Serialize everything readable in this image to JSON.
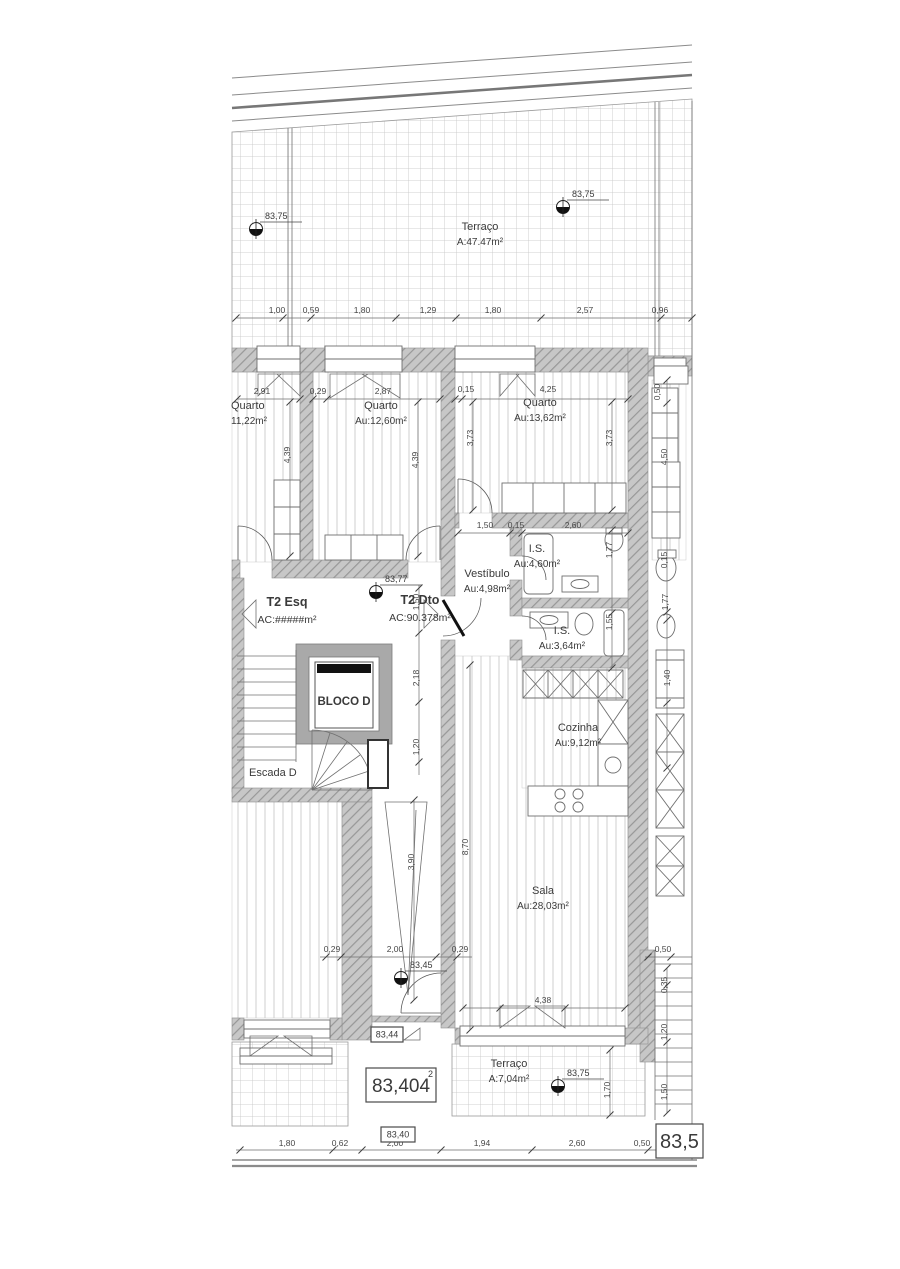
{
  "document_type": "architectural-floor-plan",
  "colors": {
    "wall_fill": "#c7c7c7",
    "wall_hatch": "#979797",
    "line": "#707070",
    "text": "#3a3a3a",
    "background": "#ffffff"
  },
  "plan": {
    "rooms": [
      {
        "name": "Terraço",
        "area": "A:47.47m²",
        "x": 480,
        "y": 230
      },
      {
        "name": "Quarto",
        "area": "11,22m²",
        "x": 231,
        "y": 409,
        "a": "start"
      },
      {
        "name": "Quarto",
        "area": "Au:12,60m²",
        "x": 381,
        "y": 409
      },
      {
        "name": "Quarto",
        "area": "Au:13,62m²",
        "x": 540,
        "y": 406
      },
      {
        "name": "I.S.",
        "area": "Au:4,60m²",
        "x": 537,
        "y": 552
      },
      {
        "name": "Vestíbulo",
        "area": "Au:4,98m²",
        "x": 487,
        "y": 577
      },
      {
        "name": "I.S.",
        "area": "Au:3,64m²",
        "x": 562,
        "y": 634
      },
      {
        "name": "Cozinha",
        "area": "Au:9,12m²",
        "x": 578,
        "y": 731
      },
      {
        "name": "Sala",
        "area": "Au:28,03m²",
        "x": 543,
        "y": 894
      },
      {
        "name": "Terraço",
        "area": "A:7,04m²",
        "x": 509,
        "y": 1067
      }
    ],
    "apartments": [
      {
        "label": "T2 Esq",
        "area": "AC:#####m²",
        "x": 287,
        "y": 606
      },
      {
        "label": "T2 Dto",
        "area": "AC:90.378m²",
        "x": 420,
        "y": 604
      }
    ],
    "core": {
      "elevator": "BLOCO D",
      "stairs": "Escada D"
    },
    "markers": [
      {
        "label": "83,75",
        "x": 256,
        "y": 229
      },
      {
        "label": "83,75",
        "x": 563,
        "y": 207
      },
      {
        "label": "83,77",
        "x": 376,
        "y": 592
      },
      {
        "label": "83,45",
        "x": 401,
        "y": 978
      },
      {
        "label": "83,75",
        "x": 558,
        "y": 1086
      }
    ],
    "stamps": [
      {
        "text": "83,404",
        "sup": "2",
        "x": 366,
        "y": 1068,
        "w": 70,
        "h": 34,
        "size": 19
      },
      {
        "text": "83,44",
        "x": 371,
        "y": 1027,
        "w": 32,
        "h": 15,
        "size": 9
      },
      {
        "text": "83,40",
        "x": 381,
        "y": 1127,
        "w": 34,
        "h": 15,
        "size": 9
      },
      {
        "text": "83,5",
        "x": 656,
        "y": 1124,
        "w": 47,
        "h": 34,
        "size": 20,
        "a": "start"
      }
    ],
    "dims_h": [
      {
        "t": "1,00",
        "x": 277,
        "y": 313
      },
      {
        "t": "0,59",
        "x": 311,
        "y": 313
      },
      {
        "t": "1,80",
        "x": 362,
        "y": 313
      },
      {
        "t": "1,29",
        "x": 428,
        "y": 313
      },
      {
        "t": "1,80",
        "x": 493,
        "y": 313
      },
      {
        "t": "2,57",
        "x": 585,
        "y": 313
      },
      {
        "t": "0,96",
        "x": 660,
        "y": 313
      },
      {
        "t": "2,91",
        "x": 262,
        "y": 394
      },
      {
        "t": "0,29",
        "x": 318,
        "y": 394
      },
      {
        "t": "2,87",
        "x": 383,
        "y": 394
      },
      {
        "t": "0,15",
        "x": 466,
        "y": 392
      },
      {
        "t": "4,25",
        "x": 548,
        "y": 392
      },
      {
        "t": "1,50",
        "x": 485,
        "y": 528
      },
      {
        "t": "0,15",
        "x": 516,
        "y": 528
      },
      {
        "t": "2,60",
        "x": 573,
        "y": 528
      },
      {
        "t": "0,29",
        "x": 332,
        "y": 952
      },
      {
        "t": "2,00",
        "x": 395,
        "y": 952
      },
      {
        "t": "0,29",
        "x": 460,
        "y": 952
      },
      {
        "t": "0,50",
        "x": 663,
        "y": 952
      },
      {
        "t": "4,38",
        "x": 543,
        "y": 1003
      },
      {
        "t": "1,80",
        "x": 287,
        "y": 1146
      },
      {
        "t": "0,62",
        "x": 340,
        "y": 1146
      },
      {
        "t": "2,00",
        "x": 395,
        "y": 1146
      },
      {
        "t": "1,94",
        "x": 482,
        "y": 1146
      },
      {
        "t": "2,60",
        "x": 577,
        "y": 1146
      },
      {
        "t": "0,50",
        "x": 642,
        "y": 1146
      }
    ],
    "dims_v": [
      {
        "t": "4,39",
        "x": 290,
        "y": 455
      },
      {
        "t": "4,39",
        "x": 418,
        "y": 460
      },
      {
        "t": "3,73",
        "x": 473,
        "y": 438
      },
      {
        "t": "3,73",
        "x": 612,
        "y": 438
      },
      {
        "t": "0,50",
        "x": 660,
        "y": 392
      },
      {
        "t": "4,50",
        "x": 667,
        "y": 457
      },
      {
        "t": "0,15",
        "x": 667,
        "y": 560
      },
      {
        "t": "1,77",
        "x": 668,
        "y": 602
      },
      {
        "t": "1,40",
        "x": 670,
        "y": 678
      },
      {
        "t": "1,77",
        "x": 612,
        "y": 550
      },
      {
        "t": "1,55",
        "x": 612,
        "y": 622
      },
      {
        "t": "1,50",
        "x": 419,
        "y": 602
      },
      {
        "t": "2,18",
        "x": 419,
        "y": 678
      },
      {
        "t": "1,20",
        "x": 419,
        "y": 747
      },
      {
        "t": "8,70",
        "x": 468,
        "y": 847
      },
      {
        "t": "3,90",
        "x": 414,
        "y": 862
      },
      {
        "t": "0,35",
        "x": 667,
        "y": 985
      },
      {
        "t": "1,20",
        "x": 667,
        "y": 1032
      },
      {
        "t": "1,50",
        "x": 667,
        "y": 1092
      },
      {
        "t": "1,70",
        "x": 610,
        "y": 1090
      }
    ],
    "dimlines_h": [
      {
        "x1": 236,
        "x2": 692,
        "y": 318,
        "ticks": [
          236,
          283,
          311,
          396,
          456,
          541,
          661,
          692
        ]
      },
      {
        "x1": 237,
        "x2": 300,
        "y": 399,
        "ticks": [
          237,
          300
        ]
      },
      {
        "x1": 313,
        "x2": 440,
        "y": 399,
        "ticks": [
          313,
          327,
          440
        ]
      },
      {
        "x1": 455,
        "x2": 628,
        "y": 399,
        "ticks": [
          455,
          462,
          628
        ]
      },
      {
        "x1": 458,
        "x2": 628,
        "y": 533,
        "ticks": [
          458,
          510,
          522,
          628
        ]
      },
      {
        "x1": 320,
        "x2": 472,
        "y": 957,
        "ticks": [
          326,
          341,
          436,
          457
        ]
      },
      {
        "x1": 645,
        "x2": 692,
        "y": 957,
        "ticks": [
          648,
          671
        ]
      },
      {
        "x1": 463,
        "x2": 625,
        "y": 1008,
        "ticks": [
          463,
          500,
          565,
          625
        ]
      },
      {
        "x1": 236,
        "x2": 676,
        "y": 1150,
        "ticks": [
          240,
          333,
          362,
          441,
          532,
          648,
          673
        ]
      }
    ],
    "dimlines_v": [
      {
        "x": 290,
        "y1": 402,
        "y2": 556,
        "ticks": [
          402,
          556
        ]
      },
      {
        "x": 418,
        "y1": 402,
        "y2": 556,
        "ticks": [
          402,
          556
        ]
      },
      {
        "x": 473,
        "y1": 402,
        "y2": 510,
        "ticks": [
          402,
          510
        ]
      },
      {
        "x": 612,
        "y1": 402,
        "y2": 510,
        "ticks": [
          402,
          510
        ]
      },
      {
        "x": 667,
        "y1": 380,
        "y2": 768,
        "ticks": [
          380,
          403,
          612,
          620,
          703,
          768
        ]
      },
      {
        "x": 612,
        "y1": 530,
        "y2": 668,
        "ticks": [
          530,
          613,
          668
        ]
      },
      {
        "x": 419,
        "y1": 585,
        "y2": 775,
        "ticks": [
          588,
          633,
          702,
          762
        ]
      },
      {
        "x": 470,
        "y1": 665,
        "y2": 1030,
        "ticks": [
          665,
          1030
        ]
      },
      {
        "x": 414,
        "y1": 800,
        "y2": 1000,
        "ticks": [
          800,
          1000
        ]
      },
      {
        "x": 667,
        "y1": 968,
        "y2": 1113,
        "ticks": [
          968,
          985,
          1042,
          1113
        ]
      },
      {
        "x": 610,
        "y1": 1050,
        "y2": 1115,
        "ticks": [
          1050,
          1115
        ]
      }
    ]
  }
}
